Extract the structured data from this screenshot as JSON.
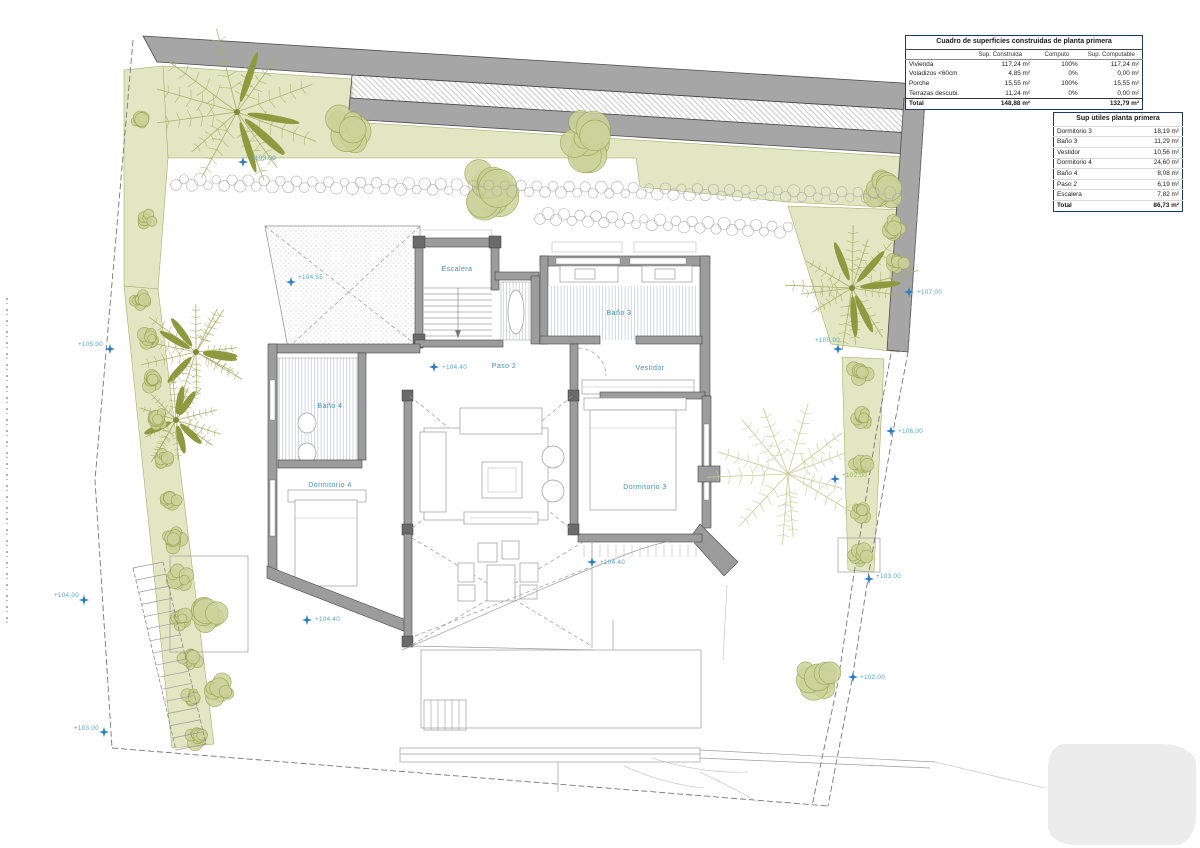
{
  "tables": {
    "built": {
      "title": "Cuadro de superficies construidas de planta primera",
      "columns": [
        "",
        "Sup. Construida",
        "Computo",
        "Sup. Computable"
      ],
      "rows": [
        {
          "name": "Vivienda",
          "built": "117,24 m²",
          "pct": "100%",
          "countable": "117,24 m²"
        },
        {
          "name": "Voladizos <60cm",
          "built": "4,85 m²",
          "pct": "0%",
          "countable": "0,00 m²"
        },
        {
          "name": "Porche",
          "built": "15,55 m²",
          "pct": "100%",
          "countable": "15,55 m²"
        },
        {
          "name": "Terrazas descubi.",
          "built": "11,24 m²",
          "pct": "0%",
          "countable": "0,00 m²"
        }
      ],
      "total": {
        "name": "Total",
        "built": "148,88 m²",
        "pct": "",
        "countable": "132,79 m²"
      }
    },
    "useful": {
      "title": "Sup utiles planta primera",
      "rows": [
        {
          "name": "Dormitorio 3",
          "value": "18,19 m²"
        },
        {
          "name": "Baño 3",
          "value": "11,29 m²"
        },
        {
          "name": "Vestidor",
          "value": "10,56 m²"
        },
        {
          "name": "Dormitorio 4",
          "value": "24,60 m²"
        },
        {
          "name": "Baño 4",
          "value": "8,08 m²"
        },
        {
          "name": "Paso 2",
          "value": "6,19 m²"
        },
        {
          "name": "Escalera",
          "value": "7,82 m²"
        }
      ],
      "total": {
        "name": "Total",
        "value": "86,73 m²"
      }
    }
  },
  "plan": {
    "room_labels": [
      {
        "label": "Escalera"
      },
      {
        "label": "Paso 2"
      },
      {
        "label": "Baño 3"
      },
      {
        "label": "Vestidor"
      },
      {
        "label": "Dormitorio 3"
      },
      {
        "label": "Baño 4"
      },
      {
        "label": "Dormitorio 4"
      }
    ],
    "elevation_markers": [
      {
        "label": "+103.00"
      },
      {
        "label": "+104.55"
      },
      {
        "label": "+104.40"
      },
      {
        "label": "+104.40"
      },
      {
        "label": "+104.40"
      },
      {
        "label": "+105.00"
      },
      {
        "label": "+104.00"
      },
      {
        "label": "+103.00"
      },
      {
        "label": "+107.00"
      },
      {
        "label": "+105.00"
      },
      {
        "label": "+106.00"
      },
      {
        "label": "+102.00"
      },
      {
        "label": "+103.00"
      },
      {
        "label": "+102.00"
      }
    ]
  },
  "colors": {
    "accent_teal": "#3e92b5",
    "marker_blue": "#2f7fc0",
    "vegetation_olive": "#98a251",
    "garden_fill": "#e2e6c3",
    "wall_gray": "#a6a6a6"
  }
}
